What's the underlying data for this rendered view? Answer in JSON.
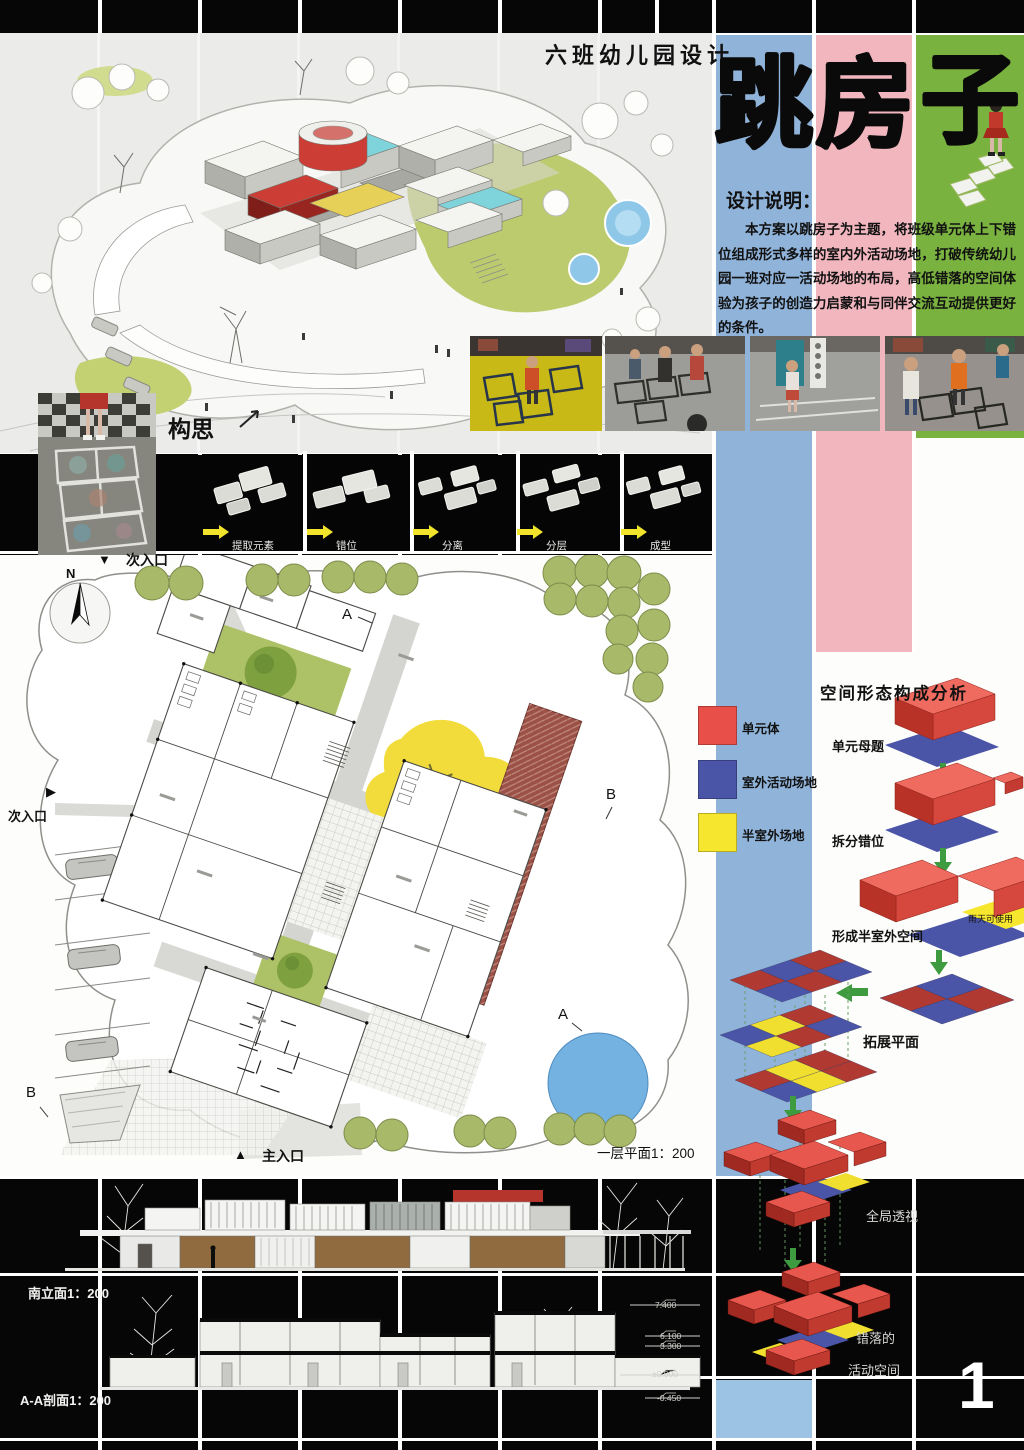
{
  "page": {
    "number": "1"
  },
  "header": {
    "project_subtitle": "六班幼儿园设计",
    "title_char_1": "跳",
    "title_char_2": "房",
    "title_char_3": "子"
  },
  "design_notes": {
    "heading": "设计说明：",
    "body": "本方案以跳房子为主题，将班级单元体上下错位组成形式多样的室内外活动场地，打破传统幼儿园一班对应一活动场地的布局，高低错落的空间体验为孩子的创造力启蒙和与同伴交流互动提供更好的条件。"
  },
  "concept": {
    "label": "构思",
    "steps": [
      {
        "label": "提取元素"
      },
      {
        "label": "错位"
      },
      {
        "label": "分离"
      },
      {
        "label": "分层"
      },
      {
        "label": "成型"
      }
    ]
  },
  "site_plan": {
    "north_label": "N",
    "entrance_top": "次入口",
    "entrance_left": "次入口",
    "entrance_main": "主入口",
    "caption": "一层平面1：200",
    "section_marks": {
      "a_top": "A",
      "b_right": "B",
      "a_bottom": "A",
      "b_left": "B"
    },
    "legend": [
      {
        "label": "单元体",
        "color": "#e84f49"
      },
      {
        "label": "室外活动场地",
        "color": "#4b55a8"
      },
      {
        "label": "半室外场地",
        "color": "#f6e62e"
      }
    ]
  },
  "analysis": {
    "title": "空间形态构成分析",
    "step_1": "单元母题",
    "step_2": "拆分错位",
    "step_3": "形成半室外空间",
    "step_4": "拓展平面",
    "step_5": "全局透视",
    "step_6_line_1": "错落的",
    "step_6_line_2": "活动空间",
    "rain_note": "雨天可使用"
  },
  "drawings": {
    "elevation_caption": "南立面1：200",
    "section_caption": "A-A剖面1：200",
    "levels": [
      "7.400",
      "6.100",
      "3.300",
      "±0.000",
      "-0.450"
    ]
  },
  "colors": {
    "column_blue": "#8fb3d9",
    "column_pink": "#f2b6bf",
    "column_green": "#7ab23f",
    "unit_red": "#e84f49",
    "field_blue": "#4b55a8",
    "semi_yellow": "#f6e62e",
    "bottom_blue_cell": "#9cc2e4"
  }
}
